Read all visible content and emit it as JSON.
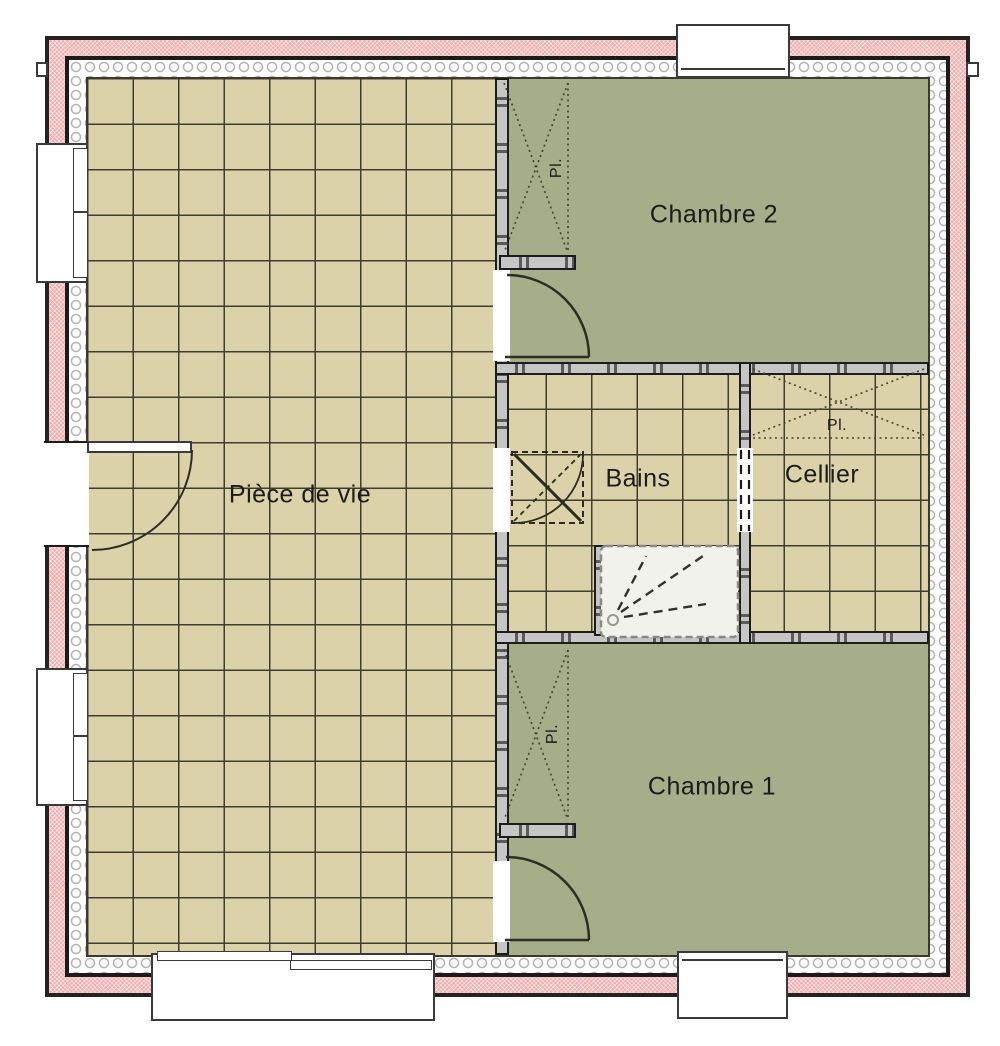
{
  "plan_title": "Floor plan ground level",
  "rooms": {
    "piece_de_vie": "Pièce de vie",
    "chambre2": "Chambre 2",
    "chambre1": "Chambre 1",
    "bains": "Bains",
    "cellier": "Cellier"
  },
  "closets": {
    "chambre2_pl": "Pl.",
    "cellier_pl": "Pl.",
    "chambre1_pl": "Pl."
  },
  "colors": {
    "exterior_wall_masonry": "#eeacac",
    "tile_floor": "#dcd2a9",
    "tile_grid_line": "#3f3e2e",
    "bedroom_floor_green": "#a6ad89",
    "interior_wall_fill": "#c6c6c6",
    "wall_outline": "#1c1c1c",
    "shower_tray": "#f2f2ed",
    "insulation": "#fdfdfd"
  }
}
